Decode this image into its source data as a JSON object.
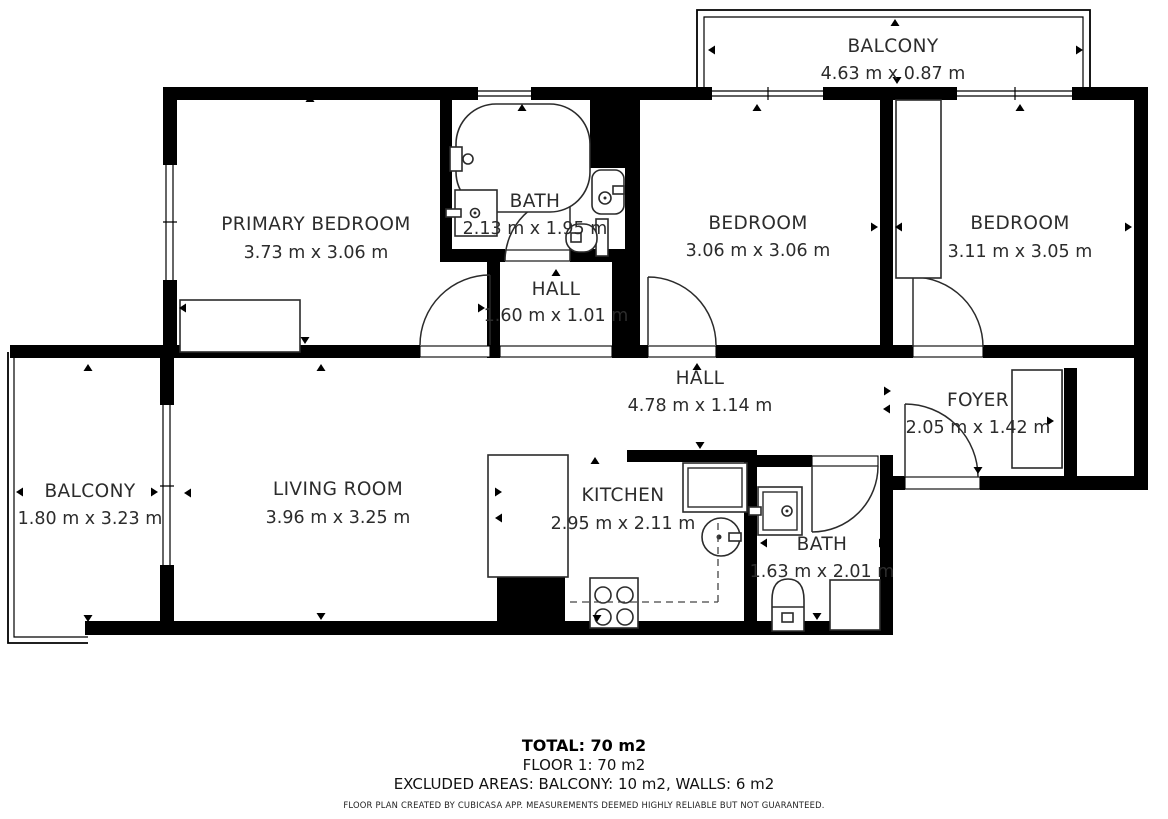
{
  "floor_plan": {
    "colors": {
      "wall": "#000000",
      "text": "#2c2c2c",
      "background": "#ffffff"
    },
    "rooms": [
      {
        "id": "balcony-top",
        "name": "BALCONY",
        "dimensions": "4.63 m x 0.87 m"
      },
      {
        "id": "primary-bedroom",
        "name": "PRIMARY BEDROOM",
        "dimensions": "3.73 m x 3.06 m"
      },
      {
        "id": "bath-top",
        "name": "BATH",
        "dimensions": "2.13 m x 1.95 m"
      },
      {
        "id": "bedroom-middle",
        "name": "BEDROOM",
        "dimensions": "3.06 m x 3.06 m"
      },
      {
        "id": "bedroom-right",
        "name": "BEDROOM",
        "dimensions": "3.11 m x 3.05 m"
      },
      {
        "id": "hall-upper",
        "name": "HALL",
        "dimensions": "1.60 m x 1.01 m"
      },
      {
        "id": "hall-main",
        "name": "HALL",
        "dimensions": "4.78 m x 1.14 m"
      },
      {
        "id": "foyer",
        "name": "FOYER",
        "dimensions": "2.05 m x 1.42 m"
      },
      {
        "id": "balcony-left",
        "name": "BALCONY",
        "dimensions": "1.80 m x 3.23 m"
      },
      {
        "id": "living-room",
        "name": "LIVING ROOM",
        "dimensions": "3.96 m x 3.25 m"
      },
      {
        "id": "kitchen",
        "name": "KITCHEN",
        "dimensions": "2.95 m x 2.11 m"
      },
      {
        "id": "bath-lower",
        "name": "BATH",
        "dimensions": "1.63 m x 2.01 m"
      }
    ],
    "summary": {
      "total": "TOTAL: 70 m2",
      "floor": "FLOOR 1: 70 m2",
      "excluded": "EXCLUDED AREAS: BALCONY: 10 m2, WALLS: 6 m2",
      "disclaimer": "FLOOR PLAN CREATED BY CUBICASA APP. MEASUREMENTS DEEMED HIGHLY RELIABLE BUT NOT GUARANTEED."
    }
  }
}
